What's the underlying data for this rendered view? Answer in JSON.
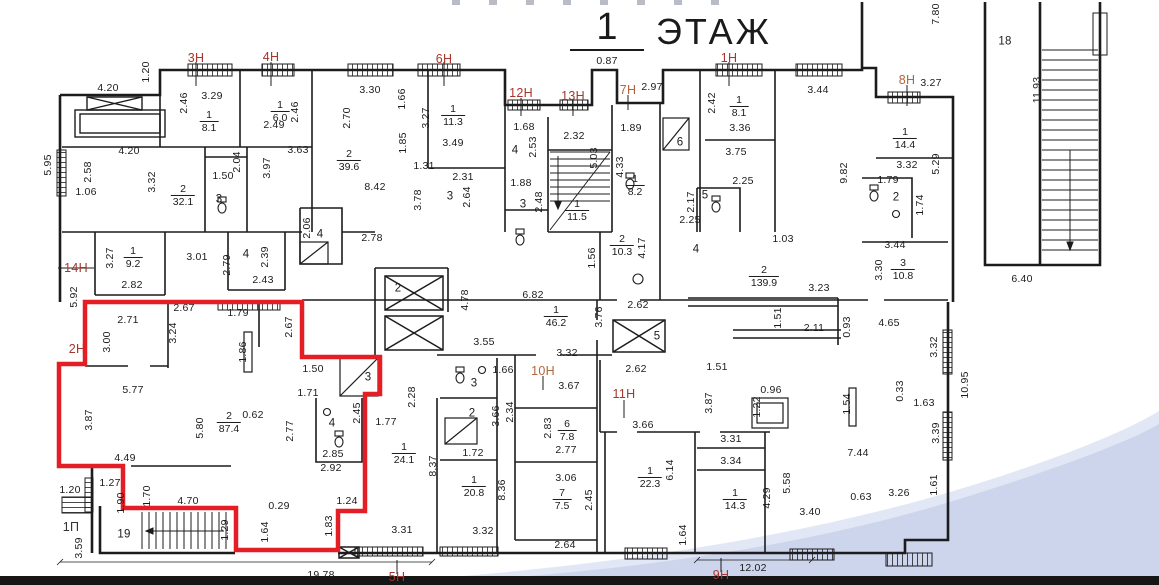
{
  "title": {
    "number": "1",
    "word": "ЭТАЖ"
  },
  "colors": {
    "wall": "#1c1c1c",
    "dimension_text": "#1b1b1b",
    "unit_label_red": "#a8352c",
    "unit_label_orange": "#b26539",
    "unit_label_black": "#333333",
    "highlight_outline": "#e31e24",
    "water_fill": "#ccd5ec",
    "water_fringe": "#e1e7f5",
    "footer_bar": "#161616",
    "background": "#ffffff"
  },
  "unit_labels": [
    [
      "3Н",
      196,
      58,
      "red"
    ],
    [
      "4Н",
      271,
      57,
      "red"
    ],
    [
      "6Н",
      444,
      59,
      "red"
    ],
    [
      "12Н",
      521,
      93,
      "red"
    ],
    [
      "13Н",
      573,
      96,
      "red"
    ],
    [
      "7Н",
      628,
      90,
      "orange"
    ],
    [
      "1Н",
      729,
      58,
      "red"
    ],
    [
      "8Н",
      907,
      80,
      "orange"
    ],
    [
      "14Н",
      76,
      268,
      "red"
    ],
    [
      "2Н",
      77,
      349,
      "red"
    ],
    [
      "10Н",
      543,
      371,
      "orange"
    ],
    [
      "11Н",
      624,
      394,
      "red"
    ],
    [
      "5Н",
      397,
      577,
      "red"
    ],
    [
      "9Н",
      721,
      575,
      "red"
    ],
    [
      "1П",
      71,
      527,
      "black"
    ]
  ],
  "room_area_labels": [
    [
      "1",
      "8.1",
      209,
      122
    ],
    [
      "1",
      "6.0",
      280,
      112
    ],
    [
      "1",
      "11.3",
      453,
      116
    ],
    [
      "2",
      "32.1",
      183,
      196
    ],
    [
      "2",
      "39.6",
      349,
      161
    ],
    [
      "1",
      "9.2",
      133,
      258
    ],
    [
      "1",
      "11.5",
      577,
      211
    ],
    [
      "1",
      "8.2",
      635,
      186
    ],
    [
      "1",
      "8.1",
      739,
      107
    ],
    [
      "1",
      "14.4",
      905,
      139
    ],
    [
      "3",
      "10.8",
      903,
      270
    ],
    [
      "2",
      "10.3",
      622,
      246
    ],
    [
      "2",
      "139.9",
      764,
      277
    ],
    [
      "1",
      "46.2",
      556,
      317
    ],
    [
      "2",
      "87.4",
      229,
      423
    ],
    [
      "6",
      "7.8",
      567,
      431
    ],
    [
      "7",
      "7.5",
      562,
      500
    ],
    [
      "1",
      "24.1",
      404,
      454
    ],
    [
      "1",
      "20.8",
      474,
      487
    ],
    [
      "1",
      "22.3",
      650,
      478
    ],
    [
      "1",
      "14.3",
      735,
      500
    ]
  ],
  "room_numbers": [
    [
      "3",
      219,
      200
    ],
    [
      "4",
      246,
      255
    ],
    [
      "3",
      450,
      197
    ],
    [
      "4",
      320,
      235
    ],
    [
      "4",
      515,
      151
    ],
    [
      "3",
      523,
      205
    ],
    [
      "6",
      680,
      143
    ],
    [
      "5",
      705,
      196
    ],
    [
      "2",
      896,
      198
    ],
    [
      "18",
      1005,
      42
    ],
    [
      "2",
      398,
      289
    ],
    [
      "5",
      657,
      337
    ],
    [
      "3",
      368,
      378
    ],
    [
      "4",
      332,
      424
    ],
    [
      "3",
      474,
      384
    ],
    [
      "2",
      472,
      414
    ],
    [
      "19",
      124,
      535
    ],
    [
      "4",
      696,
      250
    ]
  ],
  "dimensions": {
    "horizontal": [
      [
        "4.20",
        108,
        88
      ],
      [
        "3.29",
        212,
        96
      ],
      [
        "2.49",
        274,
        125
      ],
      [
        "3.30",
        370,
        90
      ],
      [
        "3.63",
        298,
        150
      ],
      [
        "4.20",
        129,
        151
      ],
      [
        "1.06",
        86,
        192
      ],
      [
        "3.49",
        453,
        143
      ],
      [
        "1.31",
        424,
        166
      ],
      [
        "2.31",
        463,
        177
      ],
      [
        "8.42",
        375,
        187
      ],
      [
        "1.50",
        223,
        176
      ],
      [
        "1.68",
        524,
        127
      ],
      [
        "2.32",
        574,
        136
      ],
      [
        "0.87",
        607,
        61
      ],
      [
        "2.97",
        652,
        87
      ],
      [
        "1.89",
        631,
        128
      ],
      [
        "1.88",
        521,
        183
      ],
      [
        "3.36",
        740,
        128
      ],
      [
        "3.44",
        818,
        90
      ],
      [
        "3.75",
        736,
        152
      ],
      [
        "2.25",
        743,
        181
      ],
      [
        "2.25",
        690,
        220
      ],
      [
        "3.27",
        931,
        83
      ],
      [
        "3.32",
        907,
        165
      ],
      [
        "1.79",
        888,
        180
      ],
      [
        "3.44",
        895,
        245
      ],
      [
        "6.40",
        1022,
        279
      ],
      [
        "3.01",
        197,
        257
      ],
      [
        "2.43",
        263,
        280
      ],
      [
        "2.82",
        132,
        285
      ],
      [
        "2.78",
        372,
        238
      ],
      [
        "1.03",
        783,
        239
      ],
      [
        "3.23",
        819,
        288
      ],
      [
        "2.11",
        814,
        328
      ],
      [
        "4.65",
        889,
        323
      ],
      [
        "2.67",
        184,
        308
      ],
      [
        "2.71",
        128,
        320
      ],
      [
        "1.79",
        238,
        313
      ],
      [
        "5.77",
        133,
        390
      ],
      [
        "0.62",
        253,
        415
      ],
      [
        "6.82",
        533,
        295
      ],
      [
        "2.62",
        638,
        305
      ],
      [
        "2.62",
        636,
        369
      ],
      [
        "3.55",
        484,
        342
      ],
      [
        "3.32",
        567,
        353
      ],
      [
        "1.50",
        313,
        369
      ],
      [
        "1.71",
        308,
        393
      ],
      [
        "1.77",
        386,
        422
      ],
      [
        "1.66",
        503,
        370
      ],
      [
        "3.67",
        569,
        386
      ],
      [
        "1.51",
        717,
        367
      ],
      [
        "0.96",
        771,
        390
      ],
      [
        "1.63",
        924,
        403
      ],
      [
        "3.66",
        643,
        425
      ],
      [
        "2.85",
        333,
        454
      ],
      [
        "2.92",
        331,
        468
      ],
      [
        "4.49",
        125,
        458
      ],
      [
        "1.27",
        110,
        483
      ],
      [
        "1.20",
        70,
        490
      ],
      [
        "4.70",
        188,
        501
      ],
      [
        "0.29",
        279,
        506
      ],
      [
        "1.24",
        347,
        501
      ],
      [
        "1.72",
        473,
        453
      ],
      [
        "2.77",
        566,
        450
      ],
      [
        "3.06",
        566,
        478
      ],
      [
        "3.31",
        402,
        530
      ],
      [
        "3.32",
        483,
        531
      ],
      [
        "2.64",
        565,
        545
      ],
      [
        "3.31",
        731,
        439
      ],
      [
        "3.34",
        731,
        461
      ],
      [
        "7.44",
        858,
        453
      ],
      [
        "0.63",
        861,
        497
      ],
      [
        "3.26",
        899,
        493
      ],
      [
        "3.40",
        810,
        512
      ],
      [
        "12.02",
        753,
        568
      ],
      [
        "19.78",
        321,
        575
      ]
    ],
    "vertical": [
      [
        "1.20",
        146,
        72
      ],
      [
        "2.46",
        184,
        103
      ],
      [
        "2.46",
        295,
        112
      ],
      [
        "5.95",
        48,
        165
      ],
      [
        "2.58",
        88,
        172
      ],
      [
        "3.32",
        152,
        182
      ],
      [
        "2.04",
        237,
        162
      ],
      [
        "3.97",
        267,
        168
      ],
      [
        "2.70",
        347,
        118
      ],
      [
        "1.66",
        402,
        99
      ],
      [
        "3.27",
        426,
        118
      ],
      [
        "1.85",
        403,
        143
      ],
      [
        "3.78",
        418,
        200
      ],
      [
        "2.64",
        467,
        197
      ],
      [
        "2.53",
        533,
        147
      ],
      [
        "2.48",
        539,
        202
      ],
      [
        "5.03",
        594,
        158
      ],
      [
        "4.33",
        620,
        167
      ],
      [
        "2.42",
        712,
        103
      ],
      [
        "2.17",
        691,
        202
      ],
      [
        "9.82",
        844,
        173
      ],
      [
        "5.29",
        936,
        164
      ],
      [
        "1.74",
        920,
        205
      ],
      [
        "3.30",
        879,
        270
      ],
      [
        "7.80",
        936,
        14
      ],
      [
        "11.93",
        1037,
        90
      ],
      [
        "3.27",
        110,
        258
      ],
      [
        "2.79",
        227,
        265
      ],
      [
        "2.39",
        265,
        257
      ],
      [
        "2.06",
        307,
        228
      ],
      [
        "5.92",
        74,
        297
      ],
      [
        "3.00",
        107,
        342
      ],
      [
        "3.24",
        173,
        333
      ],
      [
        "1.86",
        243,
        352
      ],
      [
        "2.67",
        289,
        327
      ],
      [
        "3.87",
        89,
        420
      ],
      [
        "5.80",
        200,
        428
      ],
      [
        "4.78",
        465,
        300
      ],
      [
        "3.76",
        599,
        317
      ],
      [
        "1.56",
        592,
        258
      ],
      [
        "4.17",
        642,
        248
      ],
      [
        "1.51",
        778,
        318
      ],
      [
        "0.93",
        847,
        327
      ],
      [
        "3.32",
        934,
        347
      ],
      [
        "10.95",
        965,
        385
      ],
      [
        "0.33",
        900,
        391
      ],
      [
        "2.45",
        357,
        413
      ],
      [
        "2.28",
        412,
        397
      ],
      [
        "3.66",
        496,
        416
      ],
      [
        "2.34",
        510,
        412
      ],
      [
        "2.83",
        548,
        428
      ],
      [
        "8.37",
        433,
        466
      ],
      [
        "8.36",
        502,
        490
      ],
      [
        "1.83",
        329,
        526
      ],
      [
        "1.29",
        225,
        530
      ],
      [
        "1.64",
        265,
        532
      ],
      [
        "1.90",
        121,
        503
      ],
      [
        "1.70",
        147,
        496
      ],
      [
        "3.59",
        79,
        548
      ],
      [
        "1.22",
        757,
        407
      ],
      [
        "1.54",
        847,
        404
      ],
      [
        "3.87",
        709,
        403
      ],
      [
        "6.14",
        670,
        470
      ],
      [
        "4.29",
        767,
        498
      ],
      [
        "5.58",
        787,
        483
      ],
      [
        "1.64",
        683,
        535
      ],
      [
        "2.45",
        589,
        500
      ],
      [
        "3.39",
        936,
        433
      ],
      [
        "1.61",
        934,
        485
      ],
      [
        "2.77",
        290,
        431
      ]
    ]
  }
}
